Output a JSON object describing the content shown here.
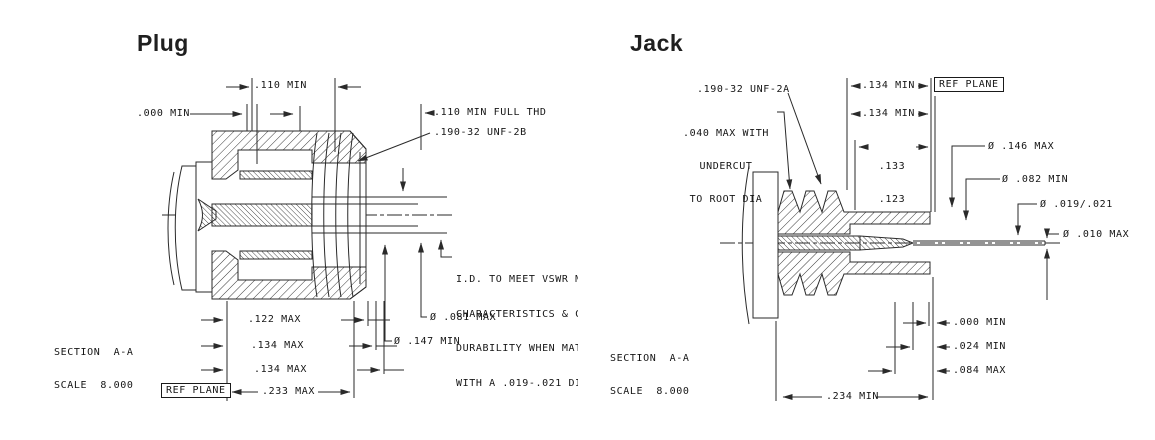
{
  "plug": {
    "title": "Plug",
    "section_label": "SECTION  A-A",
    "scale_label": "SCALE  8.000",
    "ref_plane_label": "REF PLANE",
    "dim_110_min": ".110 MIN",
    "dim_000_min": ".000 MIN",
    "dim_110_full_thd": ".110 MIN FULL THD",
    "thread_spec": ".190-32 UNF-2B",
    "note_lines": [
      "I.D. TO MEET VSWR MA",
      "CHARACTERISTICS & CO",
      "DURABILITY WHEN MATE",
      "WITH A .019-.021 DIA"
    ],
    "dia_081_max": "Ø .081 MAX",
    "dia_147_min": "Ø .147 MIN",
    "dim_122_max": ".122 MAX",
    "dim_134_max_a": ".134 MAX",
    "dim_134_max_b": ".134 MAX",
    "dim_233_max": ".233 MAX"
  },
  "jack": {
    "title": "Jack",
    "section_label": "SECTION  A-A",
    "scale_label": "SCALE  8.000",
    "ref_plane_label": "REF PLANE",
    "thread_spec": ".190-32 UNF-2A",
    "undercut_note": [
      ".040 MAX WITH",
      "UNDERCUT",
      "TO ROOT DIA"
    ],
    "dim_134_min_a": ".134 MIN",
    "dim_134_min_b": ".134 MIN",
    "dim_133": ".133",
    "dim_123": ".123",
    "dia_146_max": "Ø .146 MAX",
    "dia_082_min": "Ø .082 MIN",
    "dia_019_021": "Ø .019/.021",
    "dia_010_max": "Ø .010 MAX",
    "dim_000_min": ".000 MIN",
    "dim_024_min": ".024 MIN",
    "dim_084_max": ".084 MAX",
    "dim_234_min": ".234 MIN"
  }
}
